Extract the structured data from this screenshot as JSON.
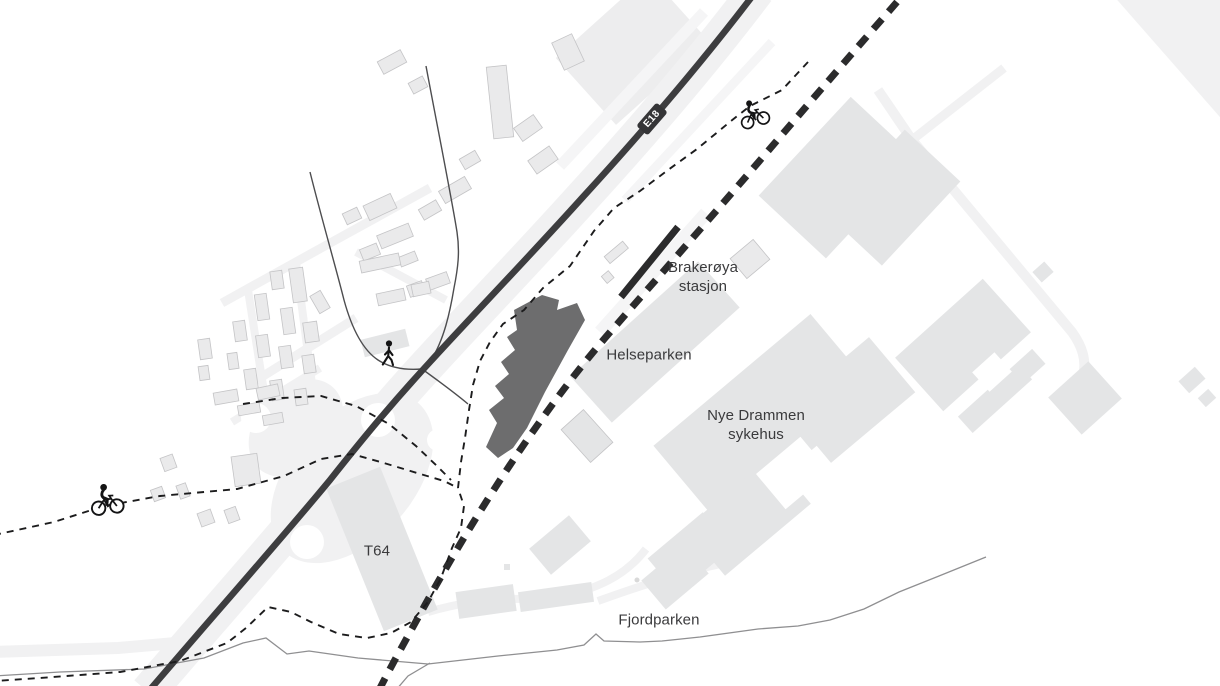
{
  "title": "Site plan map – Brakerøya / Drammen helsepark area",
  "labels": {
    "brakeroya": {
      "line1": "Brakerøya",
      "line2": "stasjon"
    },
    "helseparken": "Helseparken",
    "hospital": {
      "line1": "Nye Drammen",
      "line2": "sykehus"
    },
    "t64": "T64",
    "fjordparken": "Fjordparken"
  },
  "badge": {
    "e18": "E18"
  },
  "icons": {
    "pedestrian": {
      "name": "pedestrian-icon",
      "glyph": "walking-figure"
    },
    "cyclist_northeast": {
      "name": "cyclist-icon",
      "glyph": "bicycle-rider"
    },
    "cyclist_west": {
      "name": "cyclist-icon",
      "glyph": "bicycle-rider"
    }
  },
  "colors": {
    "bg": "#ffffff",
    "field": "#ededee",
    "road-faint": "#f1f1f2",
    "road-fainter": "#f5f5f6",
    "building": "#e4e5e6",
    "building-res": "#eaeaeb",
    "building-outline": "#c4c4c6",
    "building-dark": "#6d6d6e",
    "e18": "#3d3d3f",
    "rail": "#2b2b2c",
    "path": "#1c1c1d",
    "local-road": "#4d4d4f",
    "shore": "#8f8f91",
    "label": "#3a3a3c",
    "badge-bg": "#353537",
    "badge-text": "#ffffff",
    "icon": "#141415"
  }
}
